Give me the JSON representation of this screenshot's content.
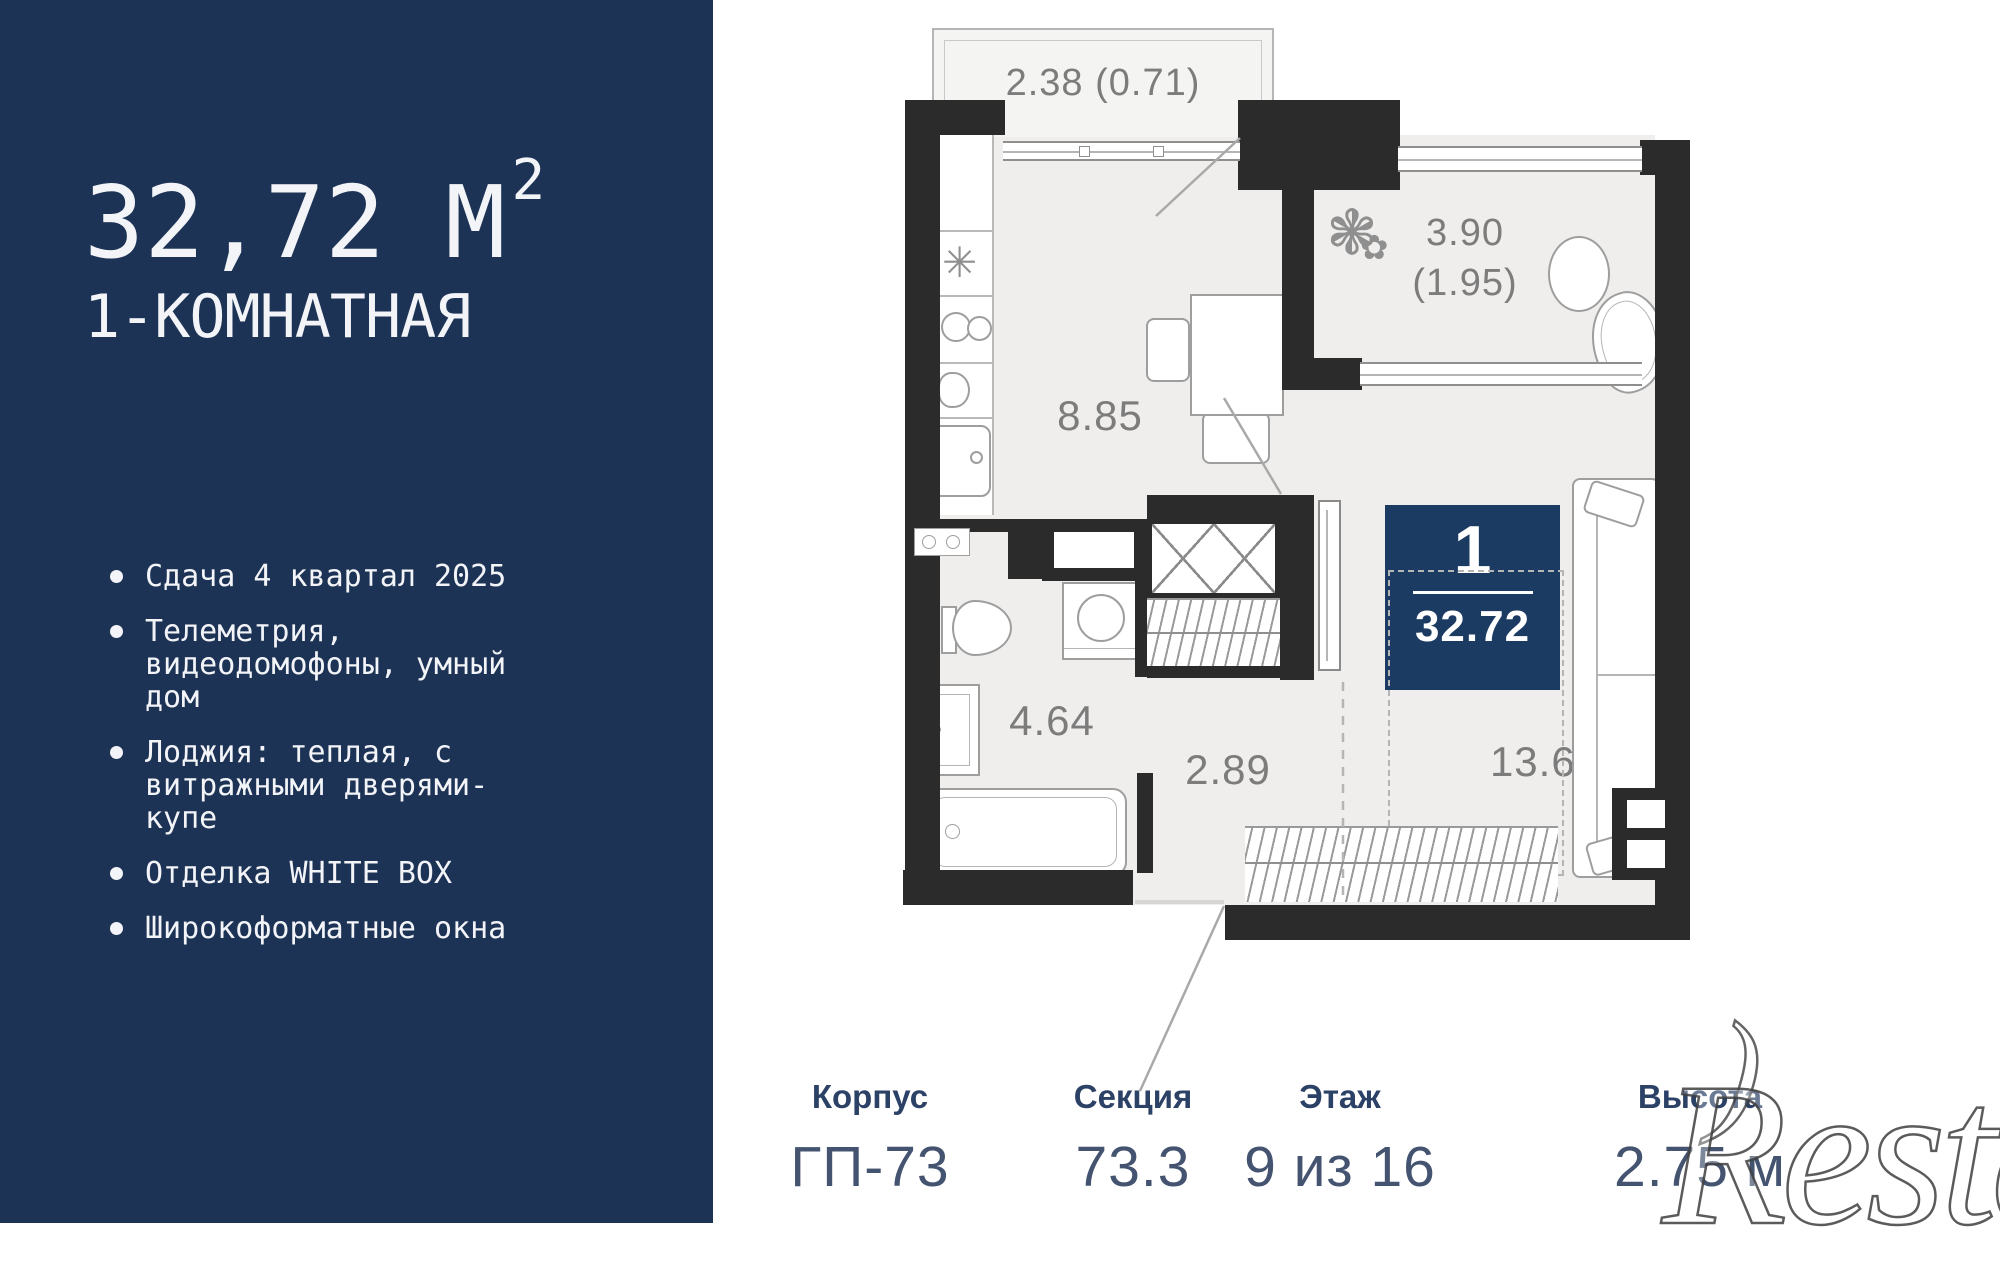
{
  "sidebar": {
    "area_value": "32,72 М",
    "area_sup": "2",
    "room_type": "1-КОМНАТНАЯ",
    "features": [
      "Сдача 4 квартал 2025",
      "Телеметрия, видеодомофоны, умный дом",
      "Лоджия: теплая, с витражными дверями-купе",
      "Отделка WHITE BOX",
      "Широкоформатные окна"
    ]
  },
  "floorplan": {
    "badge": {
      "rooms": "1",
      "area": "32.72"
    },
    "rooms": {
      "kitchen": {
        "area": "8.85"
      },
      "bathroom": {
        "area": "4.64"
      },
      "hallway": {
        "area": "2.89"
      },
      "living": {
        "area": "13.68"
      },
      "loggia": {
        "area": "3.90",
        "area_secondary": "(1.95)"
      },
      "balcony": {
        "area": "2.38 (0.71)"
      }
    }
  },
  "info": {
    "items": [
      {
        "label": "Корпус",
        "value": "ГП-73"
      },
      {
        "label": "Секция",
        "value": "73.3"
      },
      {
        "label": "Этаж",
        "value": "9 из 16"
      },
      {
        "label": "Высота",
        "value": "2.75 м"
      }
    ]
  },
  "icons": {
    "snowflake": "✳",
    "plant_large": "❃",
    "plant_small": "✿"
  },
  "watermark": {
    "text": "Restate",
    "mark": ")"
  },
  "colors": {
    "sidebar_bg": "#1d3355",
    "badge_bg": "#1b3b63",
    "wall": "#2b2b2c",
    "floor": "#efeeec",
    "info_label": "#2c4166",
    "info_value": "#44536f"
  }
}
